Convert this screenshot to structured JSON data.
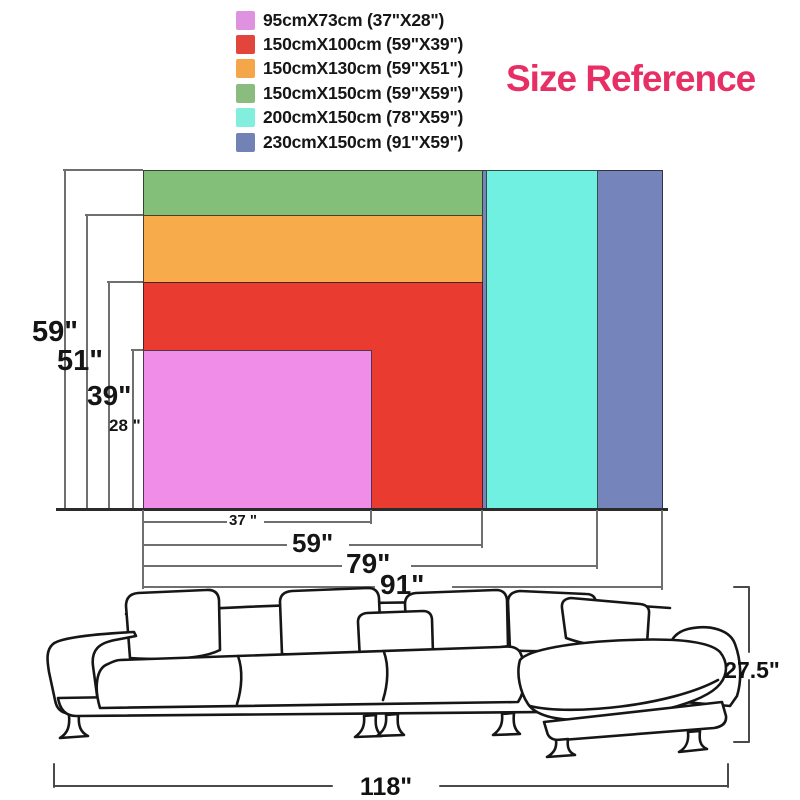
{
  "title": {
    "text": "Size Reference",
    "color": "#e72f66"
  },
  "legend": {
    "items": [
      {
        "label": "95cmX73cm (37\"X28\")",
        "color": "#df92df"
      },
      {
        "label": "150cmX100cm (59\"X39\")",
        "color": "#e2453c"
      },
      {
        "label": "150cmX130cm (59\"X51\")",
        "color": "#f5a648"
      },
      {
        "label": "150cmX150cm (59\"X59\")",
        "color": "#8abc80"
      },
      {
        "label": "200cmX150cm (78\"X59\")",
        "color": "#82eedd"
      },
      {
        "label": "230cmX150cm (91\"X59\")",
        "color": "#7382b4"
      }
    ]
  },
  "diagram": {
    "rects": {
      "r230": {
        "size": "230cmX150cm (91\"X59\")",
        "color": "#7584ba"
      },
      "r200": {
        "size": "200cmX150cm (78\"X59\")",
        "color": "#6ff0e0"
      },
      "r150sq": {
        "size": "150cmX150cm (59\"X59\")",
        "color": "#83bf79"
      },
      "r150x130": {
        "size": "150cmX130cm (59\"X51\")",
        "color": "#f8ab4b"
      },
      "r150x100": {
        "size": "150cmX100cm (59\"X39\")",
        "color": "#ea3b31"
      },
      "r95": {
        "size": "95cmX73cm (37\"X28\")",
        "color": "#ef8de8"
      }
    },
    "height_labels": {
      "h59": "59\"",
      "h51": "51\"",
      "h39": "39\"",
      "h28": "28 \""
    },
    "width_labels": {
      "w37": "37 \"",
      "w59": "59\"",
      "w79": "79\"",
      "w91": "91\""
    }
  },
  "sofa": {
    "height_label": "27.5\"",
    "width_label": "118\""
  }
}
